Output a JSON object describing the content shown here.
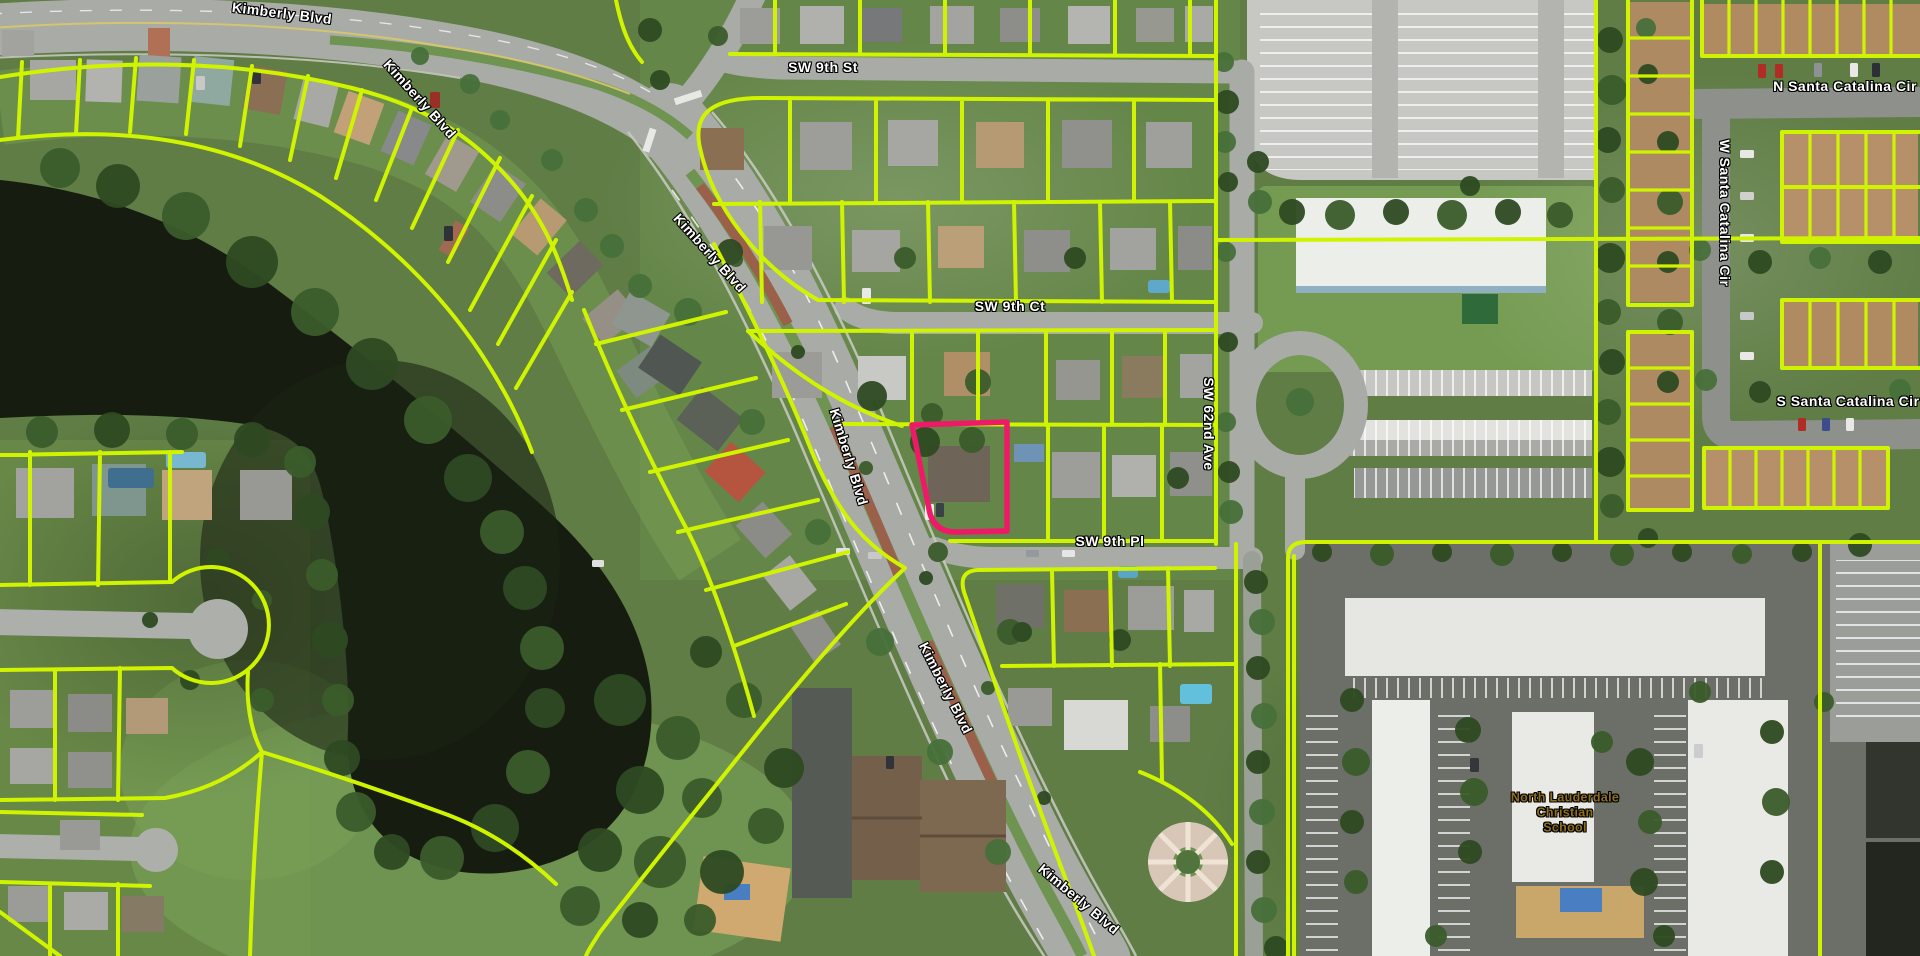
{
  "map": {
    "description": "Aerial parcel map with a highlighted parcel at the corner of Kimberly Blvd and SW 9th Pl",
    "parcel_line_color": "#d0f400",
    "highlight_color": "#ee1a68",
    "water_color": "#161c10",
    "road_color": "#a9aba7",
    "highlighted_parcel_path": "M 912 425 L 1007 422 L 1007 531 L 958 532 Q 933 533 929 509 Z"
  },
  "labels": {
    "streets": [
      {
        "id": "kimberly-blvd-1",
        "text": "Kimberly Blvd",
        "x": 282,
        "y": 13,
        "rotation": 7
      },
      {
        "id": "kimberly-blvd-2",
        "text": "Kimberly Blvd",
        "x": 420,
        "y": 99,
        "rotation": 48
      },
      {
        "id": "kimberly-blvd-3",
        "text": "Kimberly Blvd",
        "x": 710,
        "y": 253,
        "rotation": 48
      },
      {
        "id": "kimberly-blvd-4",
        "text": "Kimberly Blvd",
        "x": 849,
        "y": 457,
        "rotation": 73
      },
      {
        "id": "kimberly-blvd-5",
        "text": "Kimberly Blvd",
        "x": 946,
        "y": 688,
        "rotation": 63
      },
      {
        "id": "kimberly-blvd-6",
        "text": "Kimberly Blvd",
        "x": 1079,
        "y": 899,
        "rotation": 40
      },
      {
        "id": "sw-9th-st",
        "text": "SW 9th St",
        "x": 823,
        "y": 67,
        "rotation": 0
      },
      {
        "id": "sw-9th-ct",
        "text": "SW 9th Ct",
        "x": 1010,
        "y": 306,
        "rotation": 0
      },
      {
        "id": "sw-9th-pl",
        "text": "SW 9th Pl",
        "x": 1110,
        "y": 541,
        "rotation": 0
      },
      {
        "id": "sw-62nd-ave",
        "text": "SW 62nd Ave",
        "x": 1209,
        "y": 424,
        "rotation": 90
      },
      {
        "id": "n-santa-catalina-cir",
        "text": "N Santa Catalina Cir",
        "x": 1845,
        "y": 86,
        "rotation": 0
      },
      {
        "id": "w-santa-catalina-cir",
        "text": "W Santa Catalina Cir",
        "x": 1725,
        "y": 213,
        "rotation": 90
      },
      {
        "id": "s-santa-catalina-cir",
        "text": "S Santa Catalina Cir",
        "x": 1848,
        "y": 401,
        "rotation": 0
      }
    ],
    "school": {
      "lines": [
        "North Lauderdale",
        "Christian",
        "School"
      ],
      "x": 1565,
      "y": 813,
      "color": "#8f6f1d"
    }
  }
}
